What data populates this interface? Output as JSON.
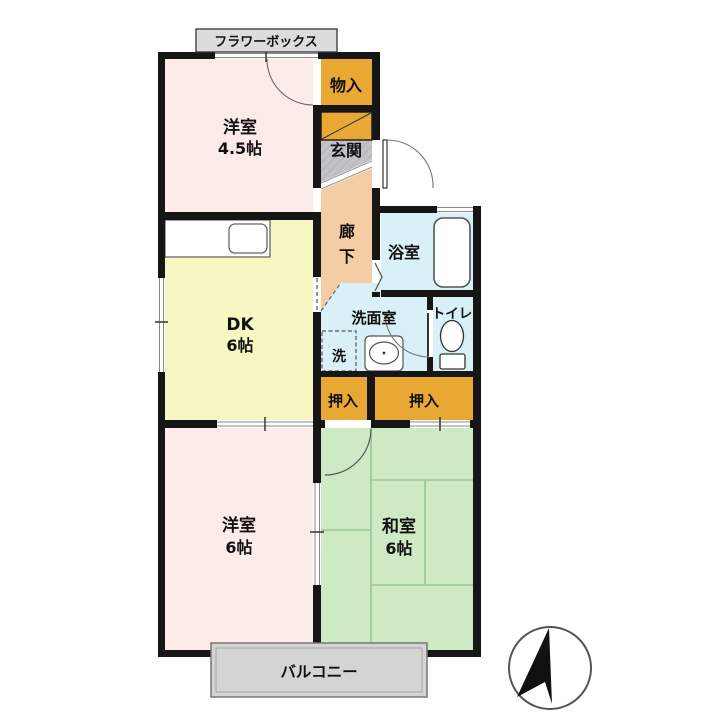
{
  "labels": {
    "flower_box": "フラワーボックス",
    "western_room_small_name": "洋室",
    "western_room_small_size": "4.5帖",
    "storage": "物入",
    "entrance": "玄関",
    "hallway_char1": "廊",
    "hallway_char2": "下",
    "bathroom": "浴室",
    "washroom": "洗面室",
    "laundry": "洗",
    "toilet": "トイレ",
    "dk_name": "DK",
    "dk_size": "6帖",
    "closet_left": "押入",
    "closet_right": "押入",
    "western_room_large_name": "洋室",
    "western_room_large_size": "6帖",
    "japanese_room_name": "和室",
    "japanese_room_size": "6帖",
    "balcony": "バルコニー"
  },
  "colors": {
    "wall": "#161616",
    "room_pink": "#fdebe9",
    "room_yellow": "#f8f7c3",
    "room_green": "#cdeac5",
    "tatami_line": "#98c795",
    "hallway_peach": "#f5cda5",
    "wet_area_blue": "#d9f0f6",
    "closet_orange": "#e9a733",
    "entrance_gray": "#c4c4c8",
    "balcony_gray": "#d4d4d4",
    "flower_box_gray": "#dcdcdc"
  }
}
